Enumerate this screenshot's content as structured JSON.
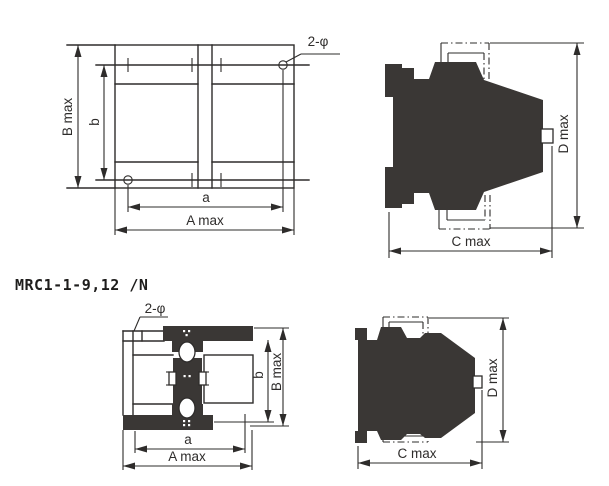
{
  "title": "MRC1-1-9,12 /N",
  "colors": {
    "line": "#2e2c2b",
    "solid_fill": "#3a3735",
    "background": "#ffffff"
  },
  "views": {
    "front_top": {
      "caption": "front view, first frame size",
      "labels": {
        "hole_note": "2-φ",
        "height_outer": "B max",
        "height_inner": "b",
        "width_inner": "a",
        "width_outer": "A max"
      }
    },
    "side_top": {
      "caption": "side view, first frame size",
      "labels": {
        "depth": "C max",
        "height": "D max"
      }
    },
    "front_bottom": {
      "caption": "front view, second frame size",
      "labels": {
        "hole_note": "2-φ",
        "height_inner": "b",
        "height_outer": "B max",
        "width_inner": "a",
        "width_outer": "A max"
      }
    },
    "side_bottom": {
      "caption": "side view, second frame size",
      "labels": {
        "depth": "C max",
        "height": "D max"
      }
    }
  }
}
